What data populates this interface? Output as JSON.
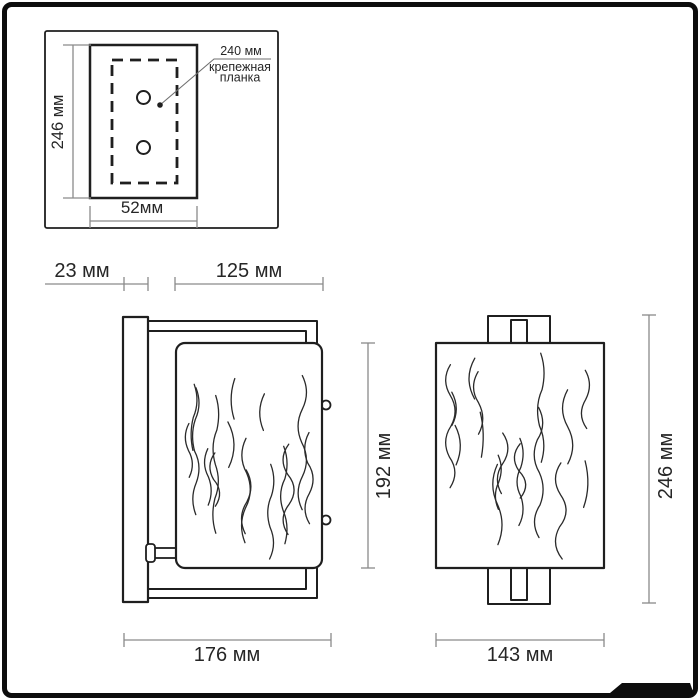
{
  "inset": {
    "height_label": "246 мм",
    "width_label": "52мм",
    "callout_dim": "240 мм",
    "callout_line1": "крепежная",
    "callout_line2": "планка"
  },
  "side_view": {
    "wall_depth_label": "23 мм",
    "top_width_label": "125 мм",
    "shade_height_label": "192 мм",
    "total_width_label": "176 мм"
  },
  "front_view": {
    "height_label": "246 мм",
    "width_label": "143 мм"
  },
  "colors": {
    "outline": "#1f1f1f",
    "dimension": "#8a8a8a",
    "text": "#262626",
    "frame": "#0d0d0d",
    "background": "#ffffff"
  }
}
